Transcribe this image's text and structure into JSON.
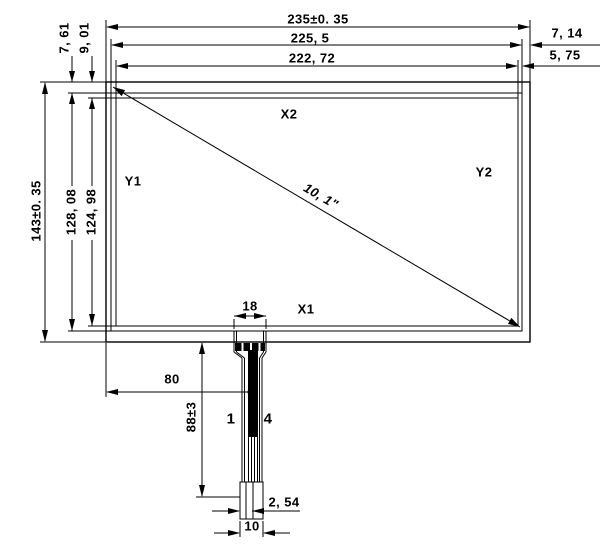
{
  "panel": {
    "label_x2": "X2",
    "label_x1": "X1",
    "label_y1": "Y1",
    "label_y2": "Y2",
    "diagonal_size": "10, 1\""
  },
  "dimensions": {
    "width_overall": "235±0. 35",
    "width_outer": "225, 5",
    "width_active": "222, 72",
    "margin_right_a": "7, 14",
    "margin_right_b": "5, 75",
    "margin_top_a": "7, 61",
    "margin_top_b": "9, 01",
    "height_overall": "143±0. 35",
    "height_outer": "128, 08",
    "height_active": "124, 98",
    "tail_width": "18",
    "tail_offset": "80",
    "tail_length": "88±3",
    "pin_pitch": "2, 54",
    "connector_width": "10"
  },
  "pins": {
    "first": "1",
    "last": "4"
  },
  "colors": {
    "line": "#000000",
    "background": "#ffffff"
  }
}
